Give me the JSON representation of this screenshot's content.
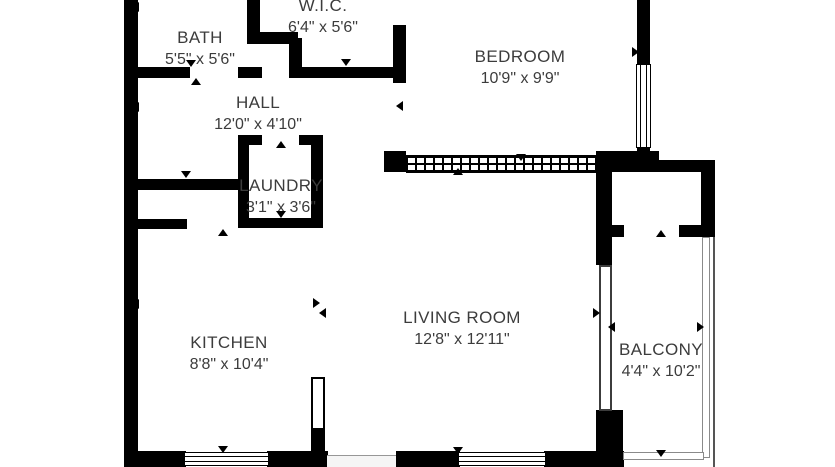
{
  "rooms": {
    "bath": {
      "name": "BATH",
      "dims": "5'5\" x 5'6\""
    },
    "wic": {
      "name": "W.I.C.",
      "dims": "6'4\" x 5'6\""
    },
    "hall": {
      "name": "HALL",
      "dims": "12'0\" x 4'10\""
    },
    "laundry": {
      "name": "LAUNDRY",
      "dims": "3'1\" x 3'6\""
    },
    "bedroom": {
      "name": "BEDROOM",
      "dims": "10'9\" x 9'9\""
    },
    "kitchen": {
      "name": "KITCHEN",
      "dims": "8'8\" x 10'4\""
    },
    "living_room": {
      "name": "LIVING ROOM",
      "dims": "12'8\" x 12'11\""
    },
    "balcony": {
      "name": "BALCONY",
      "dims": "4'4\" x 10'2\""
    }
  },
  "colors": {
    "wall": "#000000",
    "text": "#3c3c3c",
    "railing": "#8a8a8a",
    "background": "#ffffff"
  },
  "markers": [
    {
      "x": 132,
      "y": 2,
      "dir": "left"
    },
    {
      "x": 186,
      "y": 60,
      "dir": "down"
    },
    {
      "x": 191,
      "y": 78,
      "dir": "up"
    },
    {
      "x": 341,
      "y": 59,
      "dir": "down"
    },
    {
      "x": 398,
      "y": 47,
      "dir": "left"
    },
    {
      "x": 132,
      "y": 102,
      "dir": "left"
    },
    {
      "x": 396,
      "y": 101,
      "dir": "left"
    },
    {
      "x": 181,
      "y": 171,
      "dir": "down"
    },
    {
      "x": 218,
      "y": 229,
      "dir": "up"
    },
    {
      "x": 276,
      "y": 141,
      "dir": "up"
    },
    {
      "x": 276,
      "y": 211,
      "dir": "down"
    },
    {
      "x": 516,
      "y": 154,
      "dir": "down"
    },
    {
      "x": 453,
      "y": 168,
      "dir": "up"
    },
    {
      "x": 632,
      "y": 47,
      "dir": "right"
    },
    {
      "x": 132,
      "y": 299,
      "dir": "left"
    },
    {
      "x": 313,
      "y": 298,
      "dir": "right"
    },
    {
      "x": 319,
      "y": 308,
      "dir": "left"
    },
    {
      "x": 593,
      "y": 308,
      "dir": "right"
    },
    {
      "x": 656,
      "y": 230,
      "dir": "up"
    },
    {
      "x": 608,
      "y": 322,
      "dir": "left"
    },
    {
      "x": 697,
      "y": 322,
      "dir": "right"
    },
    {
      "x": 656,
      "y": 450,
      "dir": "down"
    },
    {
      "x": 218,
      "y": 446,
      "dir": "down"
    },
    {
      "x": 453,
      "y": 447,
      "dir": "down"
    }
  ]
}
